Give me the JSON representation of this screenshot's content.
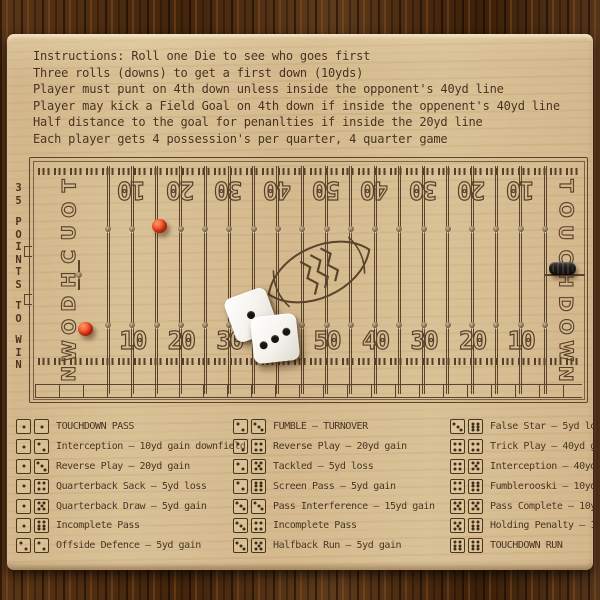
{
  "instructions": {
    "lines": [
      "Instructions:  Roll one Die to see who goes first",
      "Three rolls (downs) to get a first down (10yds)",
      "Player must punt on 4th down unless inside the opponent's 40yd line",
      "Player may kick a Field Goal on 4th down if inside the oppenent's 40yd line",
      "Half distance to the goal for penanlties if inside the 20yd line",
      "Each player gets 4 possession's per quarter, 4 quarter game"
    ]
  },
  "side_label": {
    "text": "35 POINTS TO WIN"
  },
  "field": {
    "endzone_left": "TOUCHDOWN",
    "endzone_right": "TOUCHDOWN",
    "line_count": 19,
    "yard_numbers_top": [
      "10",
      "20",
      "30",
      "40",
      "50",
      "40",
      "30",
      "20",
      "10"
    ],
    "yard_numbers_bottom": [
      "10",
      "20",
      "30",
      "40",
      "50",
      "40",
      "30",
      "20",
      "10"
    ]
  },
  "pieces": {
    "dice_faces": [
      1,
      3
    ],
    "pegs": [
      {
        "id": "red-peg-top",
        "color": "#ec431f"
      },
      {
        "id": "red-peg-left",
        "color": "#ec431f"
      },
      {
        "id": "black-peg-right",
        "color": "#211d1a"
      }
    ]
  },
  "legend": {
    "columns": [
      {
        "rows": [
          {
            "dice": [
              1,
              1
            ],
            "label": "TOUCHDOWN PASS"
          },
          {
            "dice": [
              1,
              2
            ],
            "label": "Interception – 10yd gain downfield"
          },
          {
            "dice": [
              1,
              3
            ],
            "label": "Reverse Play – 20yd gain"
          },
          {
            "dice": [
              1,
              4
            ],
            "label": "Quarterback Sack – 5yd loss"
          },
          {
            "dice": [
              1,
              5
            ],
            "label": "Quarterback Draw – 5yd gain"
          },
          {
            "dice": [
              1,
              6
            ],
            "label": "Incomplete Pass"
          },
          {
            "dice": [
              2,
              2
            ],
            "label": "Offside Defence – 5yd gain"
          }
        ]
      },
      {
        "rows": [
          {
            "dice": [
              2,
              3
            ],
            "label": "FUMBLE – TURNOVER"
          },
          {
            "dice": [
              2,
              4
            ],
            "label": "Reverse Play – 20yd gain"
          },
          {
            "dice": [
              2,
              5
            ],
            "label": "Tackled – 5yd loss"
          },
          {
            "dice": [
              2,
              6
            ],
            "label": "Screen Pass – 5yd gain"
          },
          {
            "dice": [
              3,
              3
            ],
            "label": "Pass Interference – 15yd gain"
          },
          {
            "dice": [
              3,
              4
            ],
            "label": "Incomplete Pass"
          },
          {
            "dice": [
              3,
              5
            ],
            "label": "Halfback Run – 5yd gain"
          }
        ]
      },
      {
        "rows": [
          {
            "dice": [
              3,
              6
            ],
            "label": "False Star – 5yd loss"
          },
          {
            "dice": [
              4,
              4
            ],
            "label": "Trick Play – 40yd gain"
          },
          {
            "dice": [
              4,
              5
            ],
            "label": "Interception – 40yd gain"
          },
          {
            "dice": [
              4,
              6
            ],
            "label": "Fumblerooski – 10yd gain"
          },
          {
            "dice": [
              5,
              5
            ],
            "label": "Pass Complete – 10yd gain"
          },
          {
            "dice": [
              5,
              6
            ],
            "label": "Holding Penalty – 10yd loss"
          },
          {
            "dice": [
              6,
              6
            ],
            "label": "TOUCHDOWN RUN"
          }
        ]
      }
    ]
  },
  "colors": {
    "board_wood": "#d8c096",
    "table_wood": "#49290f",
    "engraving": "#46321f",
    "peg_red": "#ec431f",
    "peg_black": "#211d1a",
    "die_white": "#f4f2ec",
    "pip_black": "#19140f"
  }
}
